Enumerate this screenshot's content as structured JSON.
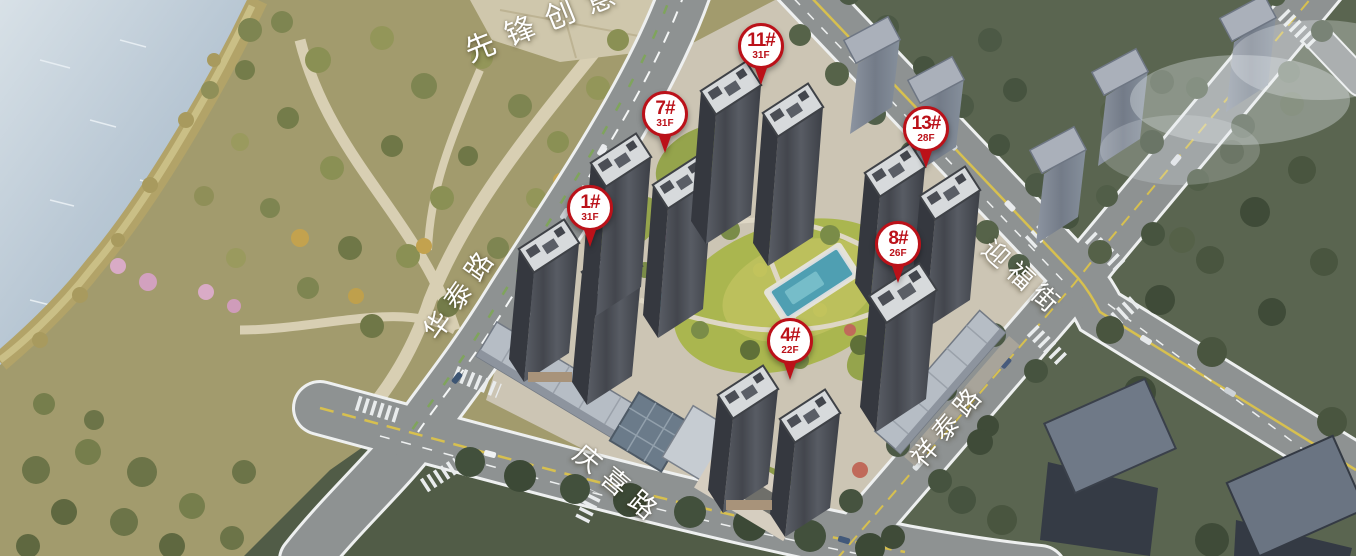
{
  "pins": [
    {
      "label": "1#",
      "floors": "31F"
    },
    {
      "label": "7#",
      "floors": "31F"
    },
    {
      "label": "11#",
      "floors": "31F"
    },
    {
      "label": "13#",
      "floors": "28F"
    },
    {
      "label": "8#",
      "floors": "26F"
    },
    {
      "label": "4#",
      "floors": "22F"
    }
  ],
  "road_labels": [
    {
      "name": "pioneer-creative-park",
      "text": "先锋创意"
    },
    {
      "name": "huatai-road",
      "text": "华泰路"
    },
    {
      "name": "qingxi-road",
      "text": "庆喜路"
    },
    {
      "name": "yingfu-street",
      "text": "迎福街"
    },
    {
      "name": "xiangtai-road",
      "text": "祥泰路"
    }
  ],
  "colors": {
    "pin_accent": "#bb1119",
    "water": "#b7c6d3",
    "park_ground": "#a29b6d",
    "road": "#8e9292",
    "pool": "#4f9fb2",
    "context_building": "#858d9a",
    "label_text": "#ffffff"
  }
}
